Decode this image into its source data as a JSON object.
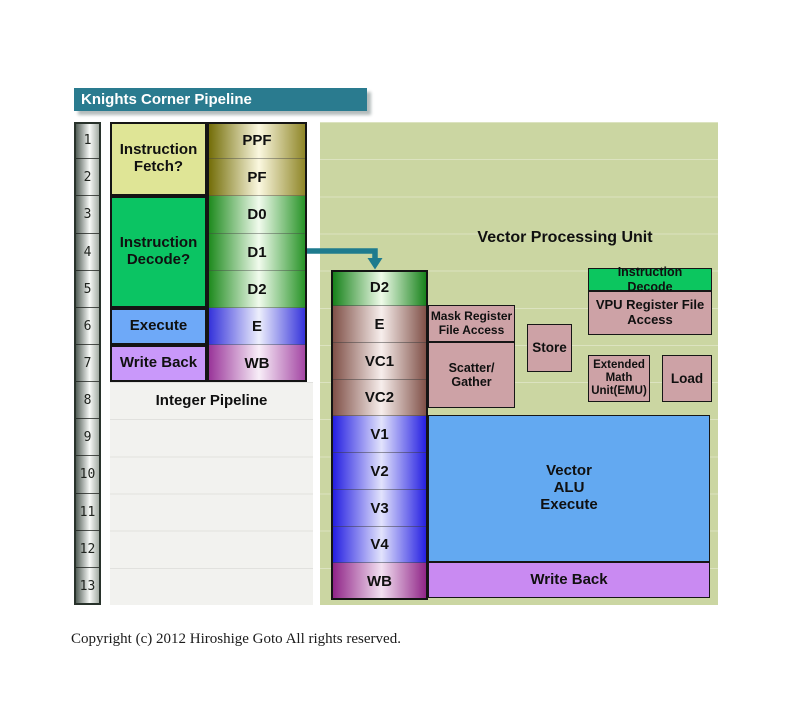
{
  "title": "Knights Corner Pipeline",
  "copyright": "Copyright (c) 2012 Hiroshige Goto All rights reserved.",
  "rows": [
    "1",
    "2",
    "3",
    "4",
    "5",
    "6",
    "7",
    "8",
    "9",
    "10",
    "11",
    "12",
    "13"
  ],
  "integer_pipeline": {
    "caption": "Integer Pipeline",
    "phases": {
      "fetch": {
        "lines": [
          "Instruction",
          "Fetch?"
        ]
      },
      "decode": {
        "lines": [
          "Instruction",
          "Decode?"
        ]
      },
      "execute": {
        "lines": [
          "Execute"
        ]
      },
      "writeback": {
        "lines": [
          "Write Back"
        ]
      }
    },
    "stages": [
      "PPF",
      "PF",
      "D0",
      "D1",
      "D2",
      "E",
      "WB"
    ]
  },
  "vector_unit": {
    "caption": "Vector Processing Unit",
    "stages": [
      "D2",
      "E",
      "VC1",
      "VC2",
      "V1",
      "V2",
      "V3",
      "V4",
      "WB"
    ],
    "blocks": {
      "instruction_decode": {
        "lines": [
          "Instruction",
          "Decode"
        ]
      },
      "vpu_register_file": {
        "lines": [
          "VPU Register File",
          "Access"
        ]
      },
      "mask_register_file": {
        "lines": [
          "Mask Register",
          "File Access"
        ]
      },
      "scatter_gather": {
        "lines": [
          "Scatter/",
          "Gather"
        ]
      },
      "store": {
        "lines": [
          "Store"
        ]
      },
      "extended_math_unit": {
        "lines": [
          "Extended",
          "Math",
          "Unit(EMU)"
        ]
      },
      "load": {
        "lines": [
          "Load"
        ]
      },
      "vector_alu": {
        "lines": [
          "Vector",
          "ALU",
          "Execute"
        ]
      },
      "write_back": {
        "lines": [
          "Write Back"
        ]
      }
    }
  },
  "colors": {
    "title_bar": "#2a7b8f",
    "vpu_background": "#cbd6a2",
    "integer_background": "#f2f2ef",
    "fetch_box": "#dfe596",
    "decode_box": "#0bc463",
    "execute_box": "#6ea9f8",
    "writeback_box": "#c998fa",
    "rosy_box": "#cda2a6",
    "vector_alu_box": "#63a9f1",
    "vector_writeback_box": "#c98af2",
    "arrow": "#1e7b8e"
  }
}
